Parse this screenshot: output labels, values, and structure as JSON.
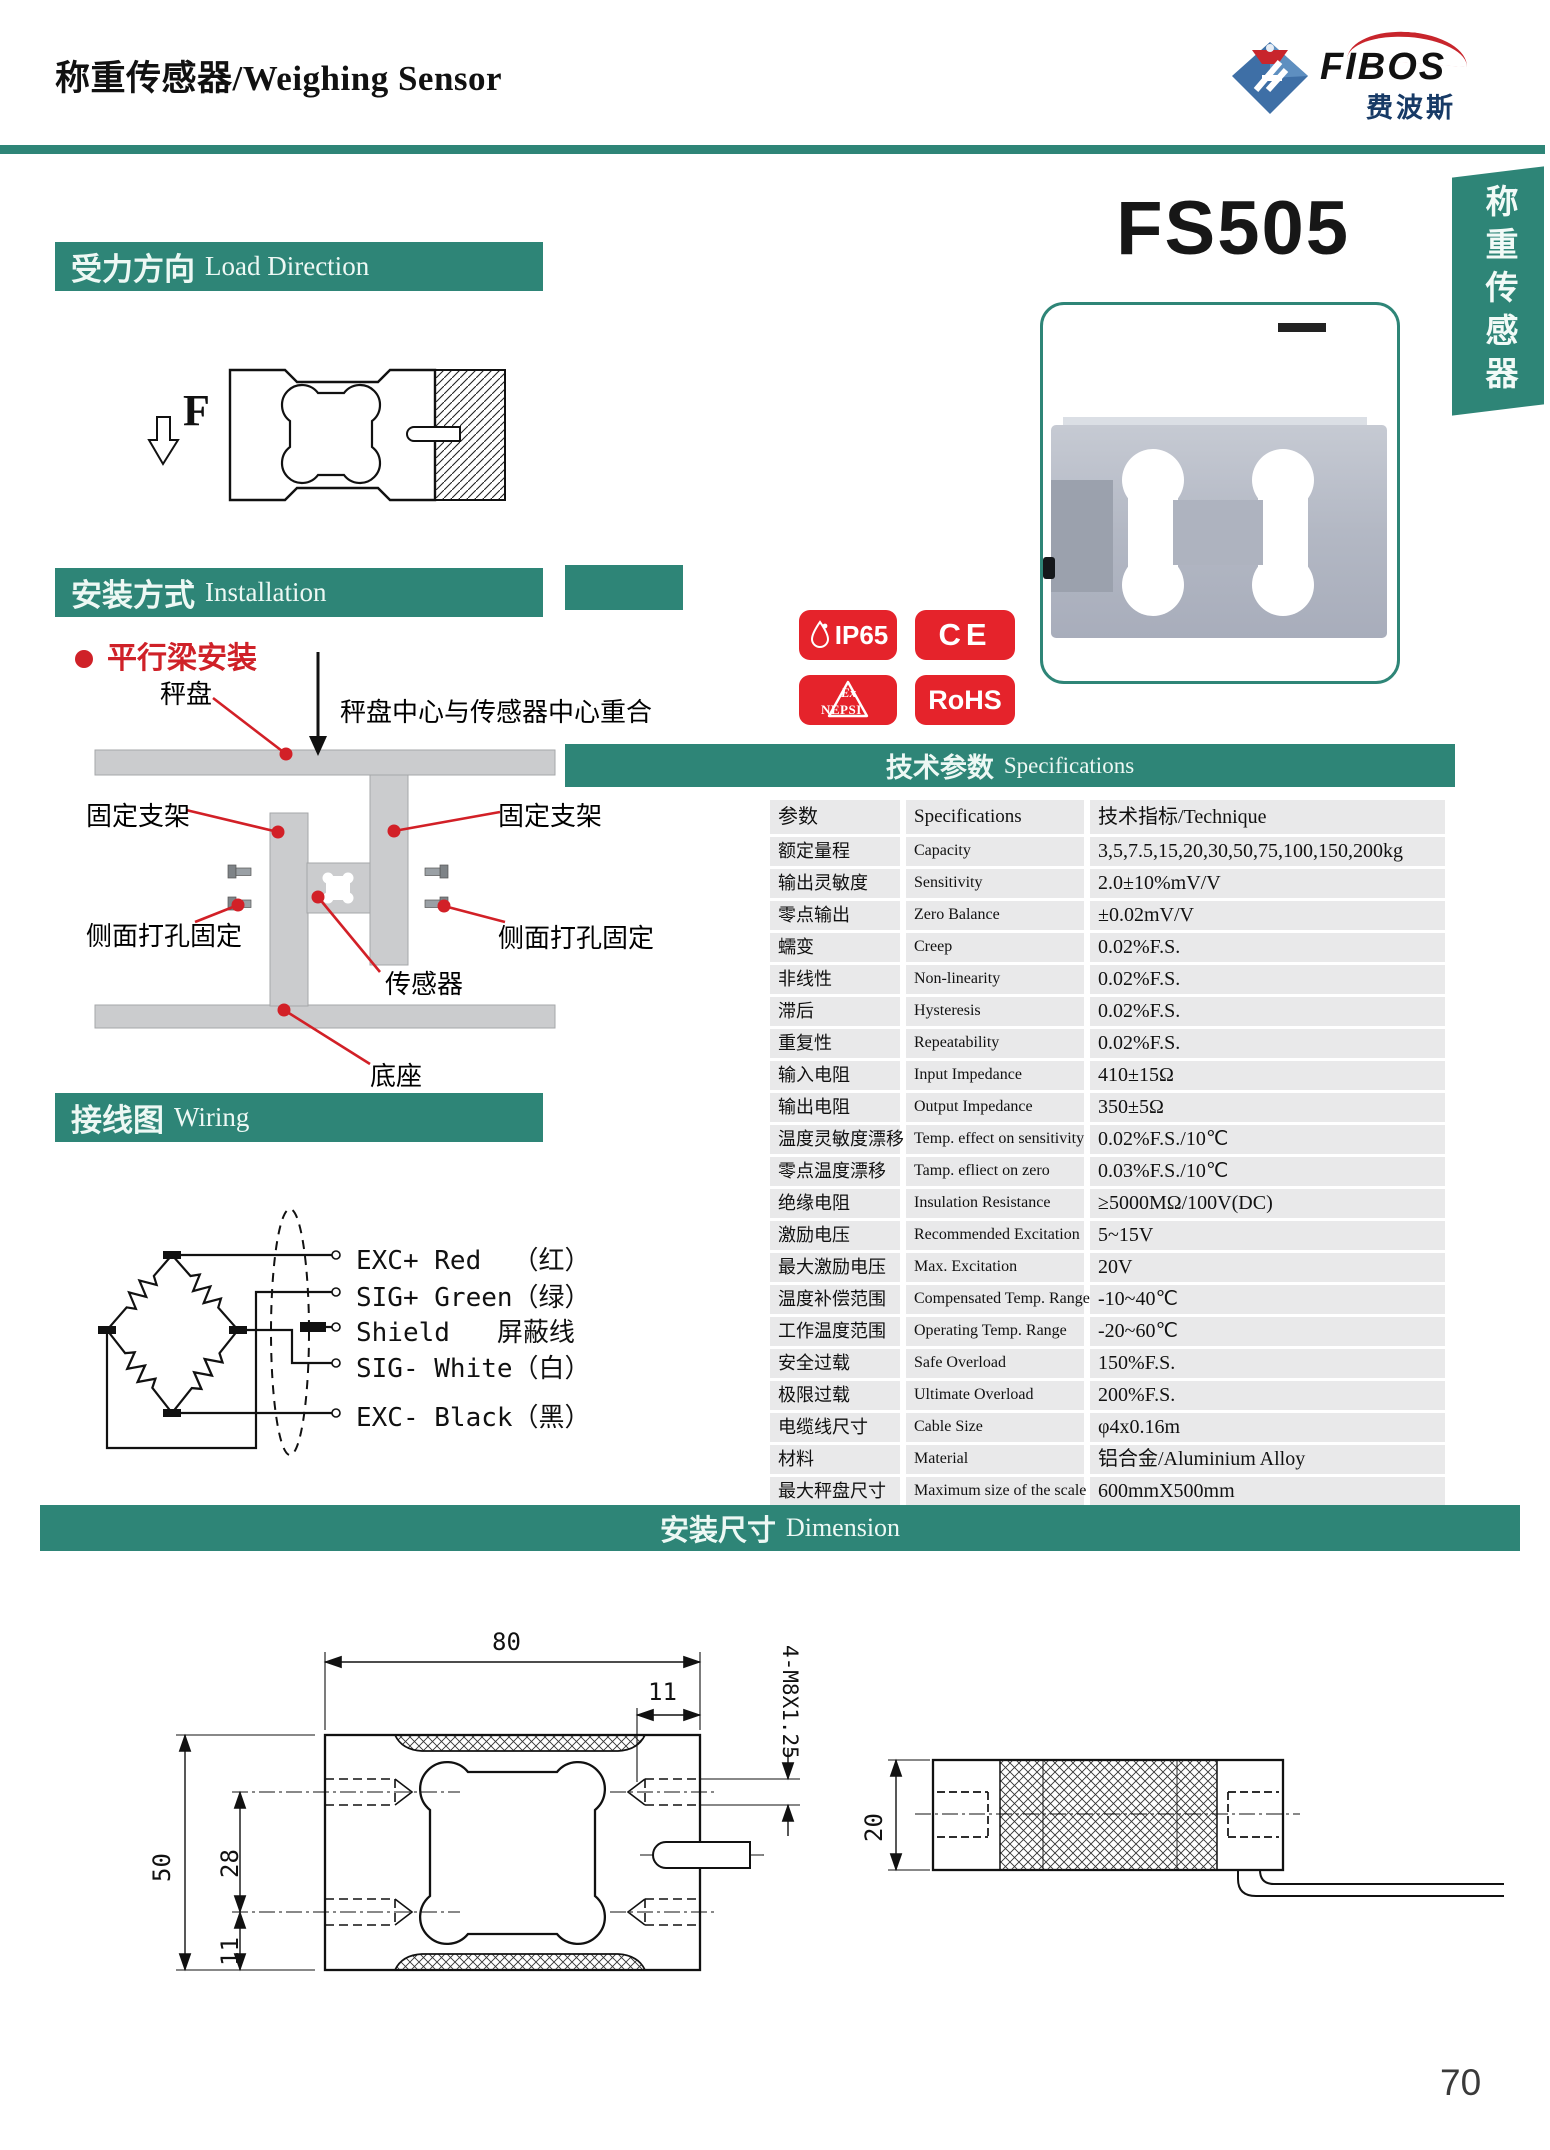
{
  "page": {
    "title": "称重传感器/Weighing Sensor",
    "model": "FS505",
    "side_tab": "称重传感器",
    "page_number": "70"
  },
  "logo": {
    "brand": "FIBOS",
    "brand_zh": "费波斯"
  },
  "sections": {
    "load_direction": {
      "zh": "受力方向",
      "en": "Load Direction"
    },
    "installation": {
      "zh": "安装方式",
      "en": "Installation"
    },
    "wiring": {
      "zh": "接线图",
      "en": "Wiring"
    },
    "specifications": {
      "zh": "技术参数",
      "en": "Specifications"
    },
    "dimension": {
      "zh": "安装尺寸",
      "en": "Dimension"
    }
  },
  "load_direction": {
    "force_label": "F"
  },
  "installation": {
    "mount_type": "平行梁安装",
    "labels": {
      "pan": "秤盘",
      "center_note": "秤盘中心与传感器中心重合",
      "bracket_left": "固定支架",
      "bracket_right": "固定支架",
      "side_fix_left": "侧面打孔固定",
      "side_fix_right": "侧面打孔固定",
      "sensor": "传感器",
      "base": "底座"
    }
  },
  "wiring": {
    "labels": [
      "EXC+ Red  （红）",
      "SIG+ Green（绿）",
      "Shield   屏蔽线",
      "SIG- White（白）",
      "EXC- Black（黑）"
    ]
  },
  "badges": {
    "ip65": "IP65",
    "ce": "CE",
    "ex_line1": "Ex",
    "ex_line2": "NEPSI",
    "rohs": "RoHS"
  },
  "specs": {
    "header": {
      "zh": "参数",
      "en": "Specifications",
      "value": "技术指标/Technique"
    },
    "rows": [
      {
        "zh": "额定量程",
        "en": "Capacity",
        "value": "3,5,7.5,15,20,30,50,75,100,150,200kg"
      },
      {
        "zh": "输出灵敏度",
        "en": "Sensitivity",
        "value": "2.0±10%mV/V"
      },
      {
        "zh": "零点输出",
        "en": "Zero Balance",
        "value": "±0.02mV/V"
      },
      {
        "zh": "蠕变",
        "en": "Creep",
        "value": "0.02%F.S."
      },
      {
        "zh": "非线性",
        "en": "Non-linearity",
        "value": "0.02%F.S."
      },
      {
        "zh": "滞后",
        "en": "Hysteresis",
        "value": "0.02%F.S."
      },
      {
        "zh": "重复性",
        "en": "Repeatability",
        "value": "0.02%F.S."
      },
      {
        "zh": "输入电阻",
        "en": "Input Impedance",
        "value": "410±15Ω"
      },
      {
        "zh": "输出电阻",
        "en": "Output Impedance",
        "value": "350±5Ω"
      },
      {
        "zh": "温度灵敏度漂移",
        "en": "Temp. effect on sensitivity",
        "value": "0.02%F.S./10℃"
      },
      {
        "zh": "零点温度漂移",
        "en": "Tamp. efliect on zero",
        "value": "0.03%F.S./10℃"
      },
      {
        "zh": "绝缘电阻",
        "en": "Insulation Resistance",
        "value": "≥5000MΩ/100V(DC)"
      },
      {
        "zh": "激励电压",
        "en": "Recommended Excitation",
        "value": "5~15V"
      },
      {
        "zh": "最大激励电压",
        "en": "Max. Excitation",
        "value": "20V"
      },
      {
        "zh": "温度补偿范围",
        "en": "Compensated Temp. Range",
        "value": "-10~40℃"
      },
      {
        "zh": "工作温度范围",
        "en": "Operating Temp. Range",
        "value": "-20~60℃"
      },
      {
        "zh": "安全过载",
        "en": "Safe Overload",
        "value": "150%F.S."
      },
      {
        "zh": "极限过载",
        "en": "Ultimate Overload",
        "value": "200%F.S."
      },
      {
        "zh": "电缆线尺寸",
        "en": "Cable Size",
        "value": "φ4x0.16m"
      },
      {
        "zh": "材料",
        "en": "Material",
        "value": "铝合金/Aluminium Alloy"
      },
      {
        "zh": "最大秤盘尺寸",
        "en": "Maximum size of the scale",
        "value": "600mmX500mm"
      }
    ]
  },
  "dimension": {
    "width": "80",
    "edge_offset": "11",
    "thread": "4-M8X1.25",
    "height": "50",
    "hole_span": "28",
    "hole_offset": "11",
    "thickness": "20"
  }
}
